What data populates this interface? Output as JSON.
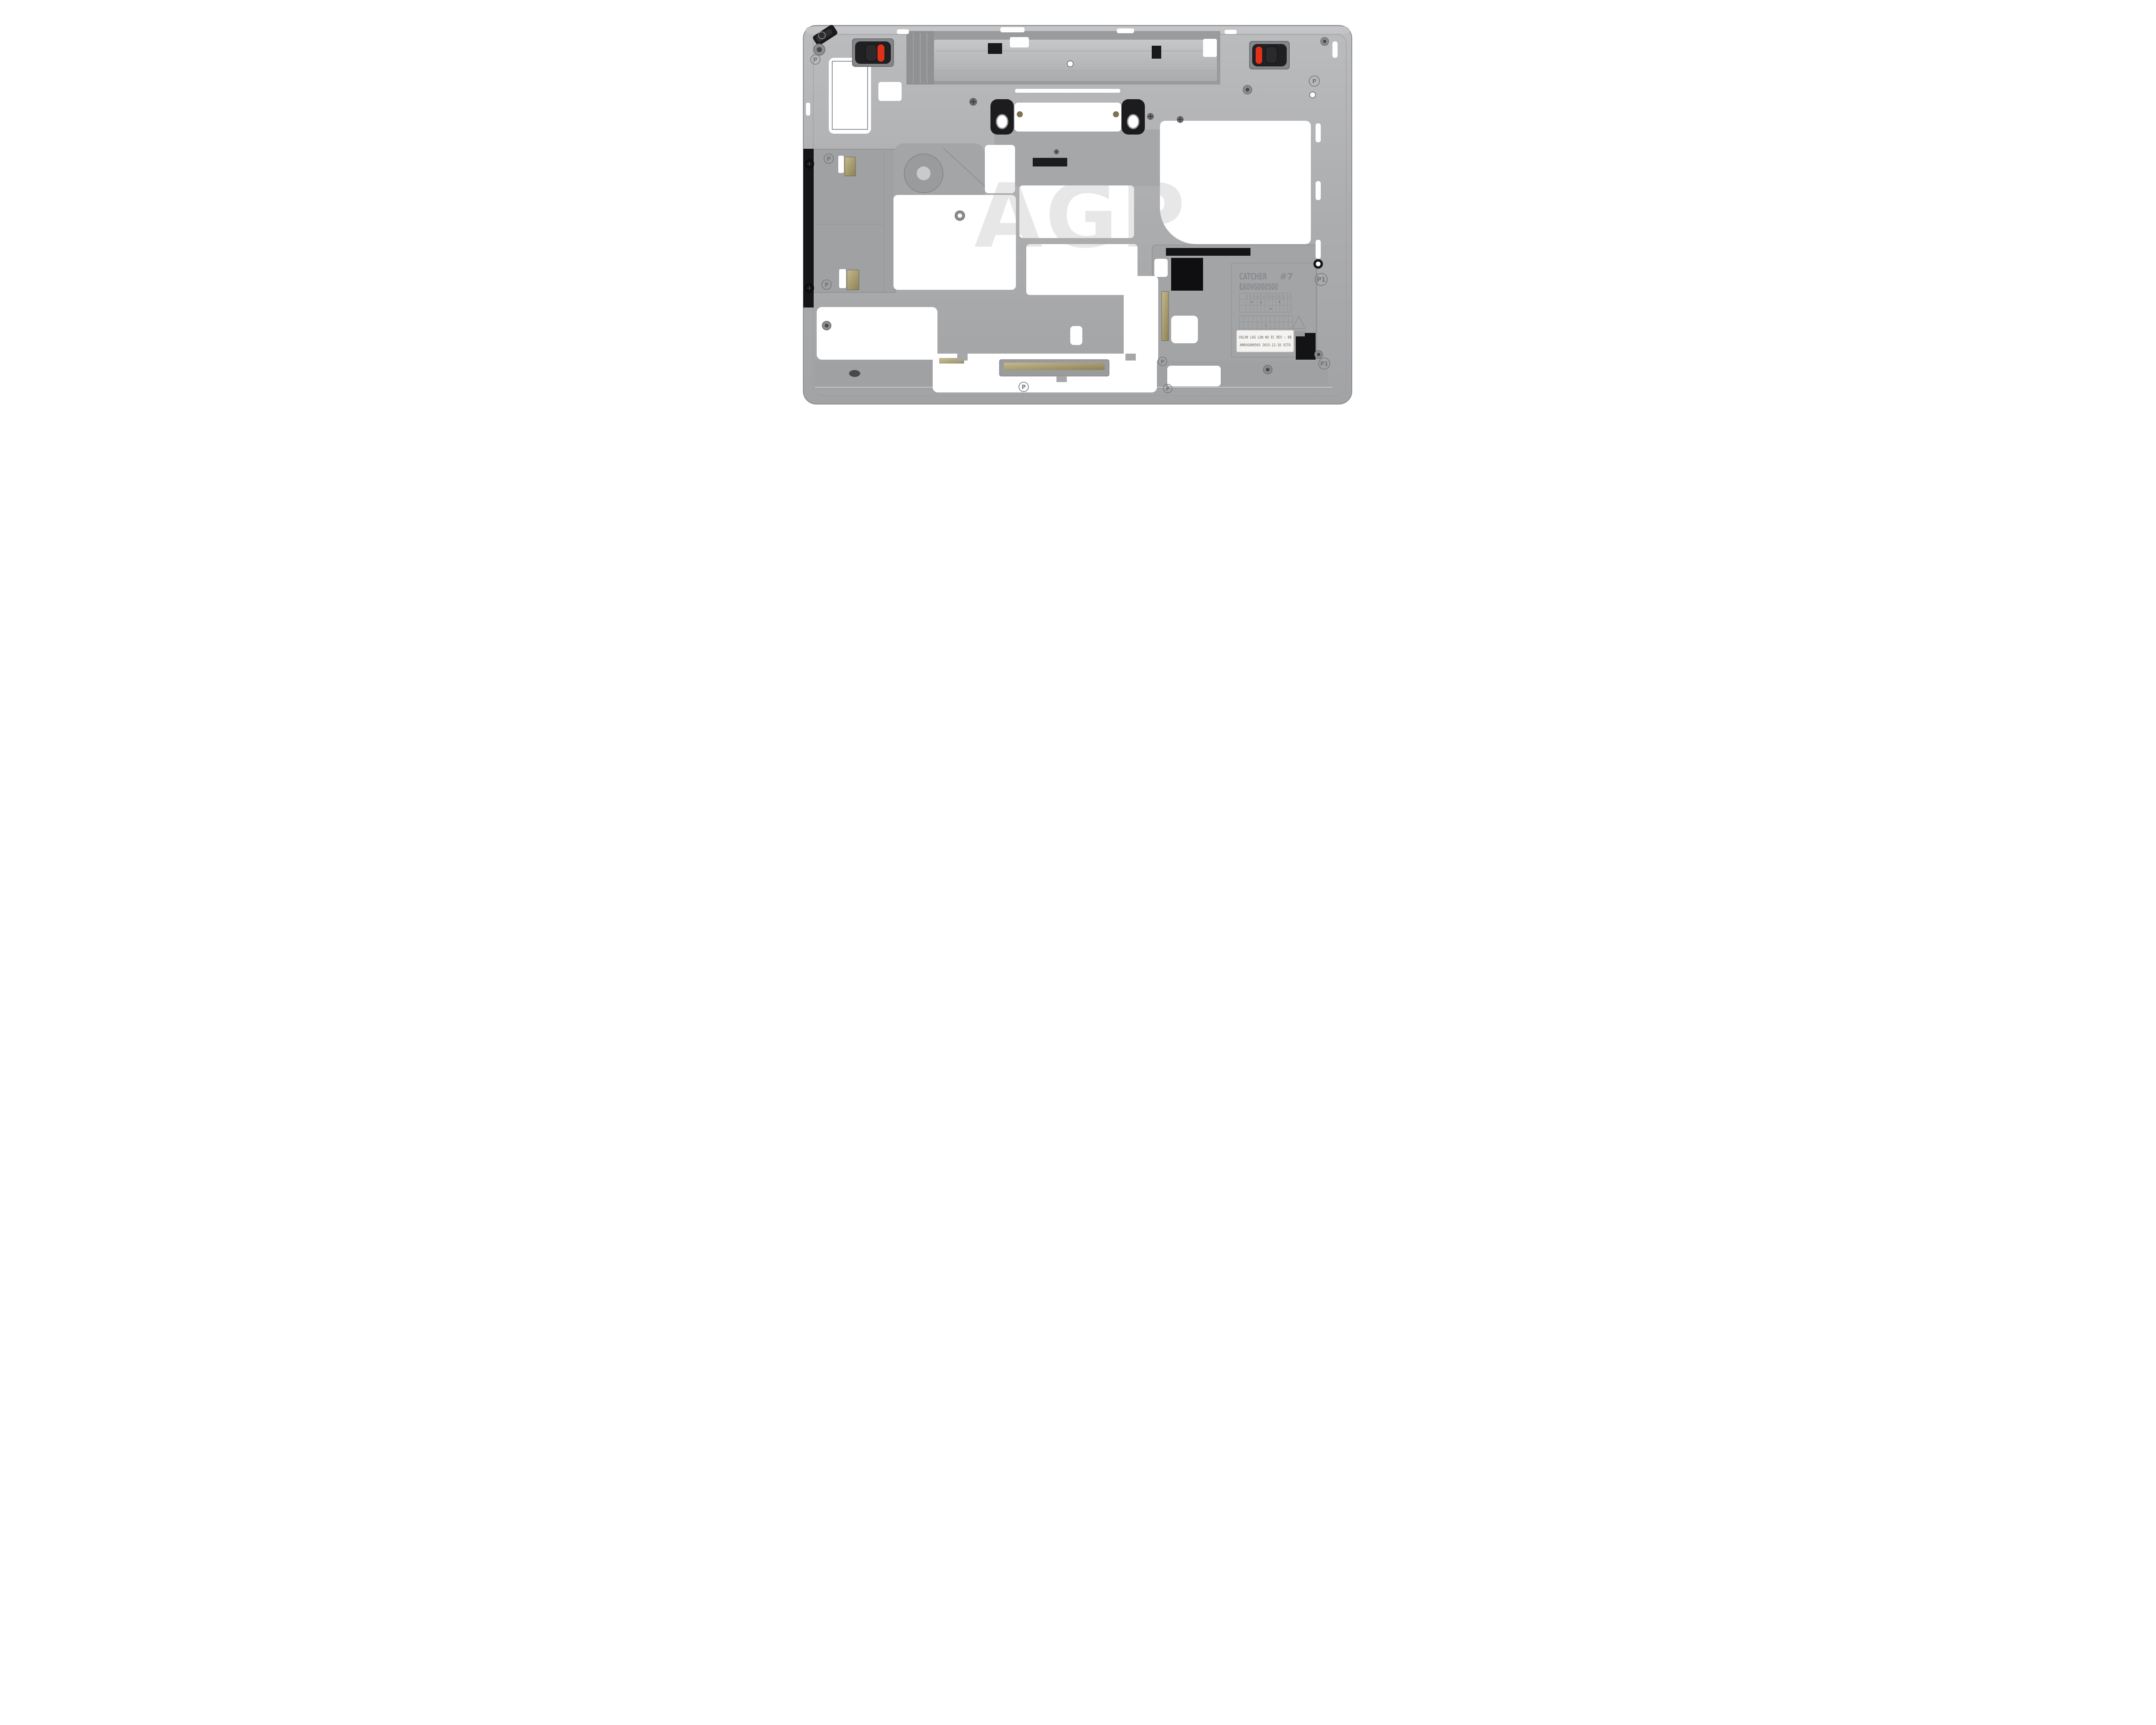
{
  "photo": {
    "alt": "Silver laptop bottom-case inner frame with black latches and red lock indicators, AGP watermark"
  },
  "watermark": {
    "text": "AGP",
    "color": "#e7e7e8"
  },
  "markings": {
    "panel_line1_left": "CATCHER",
    "panel_line1_right": "#7",
    "panel_line2": "EA0VG000500",
    "grid_header": "1 2 3 4 5 6 7 8 9 10 11 12",
    "grid_mark": "5",
    "p_mark": "P",
    "p1_mark": "P1",
    "sticker_line1": "VAL90 LOG LOW WO EC REV : 0B",
    "sticker_line2": "AM0VG000503 2015-12-28 VITO"
  },
  "colors": {
    "background": "#ffffff",
    "chassis_silver": "#aeafb1",
    "chassis_dark": "#98999b",
    "chassis_light": "#c3c4c6",
    "recess": "#9b9c9e",
    "black_part": "#1b1b1d",
    "red_indicator": "#e23119",
    "gold_contact": "#ac9f74",
    "engraving": "#85868a",
    "sticker_bg": "#f4f3f1",
    "sticker_text": "#5f645c"
  },
  "icons": {
    "recycling_triangle": "triangle-outline",
    "screw": "phillips-cross",
    "latch": "slider-with-red-indicator"
  }
}
